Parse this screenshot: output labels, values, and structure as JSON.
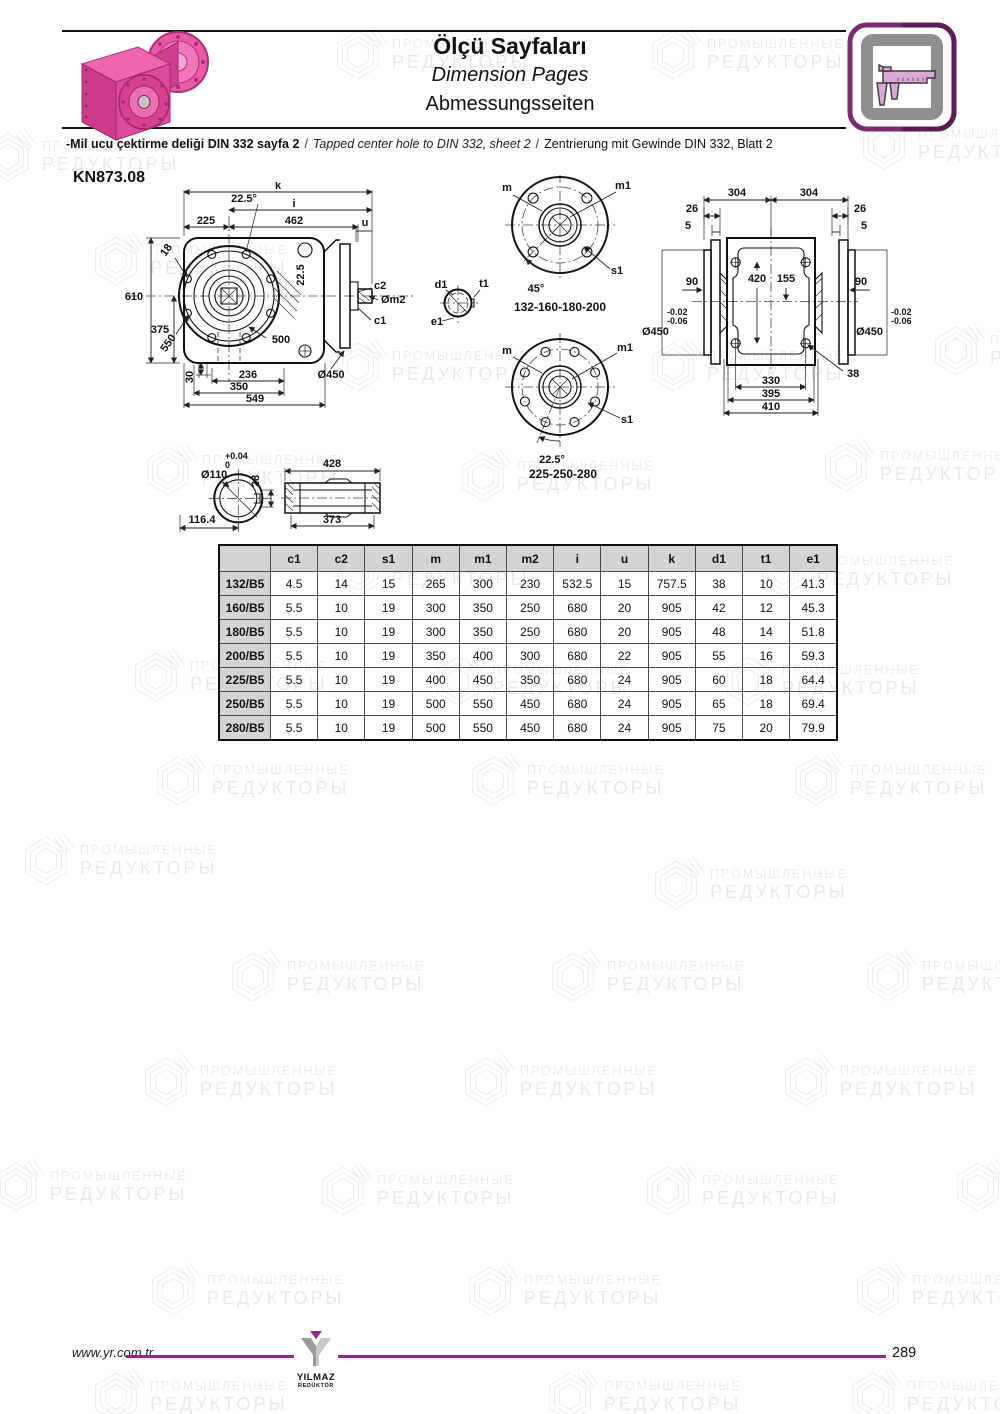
{
  "header": {
    "title_tr": "Ölçü Sayfaları",
    "title_en": "Dimension Pages",
    "title_de": "Abmessungsseiten",
    "note_tr": "-Mil ucu çektirme deliği DIN 332 sayfa 2",
    "note_en": "Tapped center hole to DIN 332, sheet 2",
    "note_de": "Zentrierung mit Gewinde DIN 332, Blatt 2",
    "note_separator": "/"
  },
  "model": "KN873.08",
  "drawings": {
    "front_view": {
      "k": "k",
      "angle_top": "22.5°",
      "i": "i",
      "d225": "225",
      "d462": "462",
      "u": "u",
      "d18": "18",
      "d610": "610",
      "d375": "375",
      "d550": "550",
      "d500": "500",
      "d22_5": "22.5",
      "c2": "c2",
      "m2": "Øm2",
      "c1": "c1",
      "d450": "Ø450",
      "d236": "236",
      "d350": "350",
      "d549": "549",
      "d30": "30"
    },
    "flange_4bolt": {
      "m": "m",
      "m1": "m1",
      "s1": "s1",
      "angle": "45°",
      "caption": "132-160-180-200"
    },
    "shaft_end": {
      "d1": "d1",
      "t1": "t1",
      "e1": "e1"
    },
    "flange_8bolt": {
      "m": "m",
      "m1": "m1",
      "s1": "s1",
      "angle": "22.5°",
      "caption": "225-250-280"
    },
    "top_view": {
      "d304": "304",
      "d26": "26",
      "d5": "5",
      "d90": "90",
      "d420": "420",
      "d155": "155",
      "tol_upper": "-0.02",
      "tol_lower": "-0.06",
      "d450": "Ø450",
      "d330": "330",
      "d395": "395",
      "d410": "410",
      "d38": "38"
    },
    "hollow_shaft": {
      "tol_upper": "+0.04",
      "tol_lower": "0",
      "d110": "Ø110",
      "d28": "28",
      "d428": "428",
      "d373": "373",
      "d116": "116.4"
    }
  },
  "table": {
    "columns": [
      "c1",
      "c2",
      "s1",
      "m",
      "m1",
      "m2",
      "i",
      "u",
      "k",
      "d1",
      "t1",
      "e1"
    ],
    "rows": [
      {
        "label": "132/B5",
        "values": [
          "4.5",
          "14",
          "15",
          "265",
          "300",
          "230",
          "532.5",
          "15",
          "757.5",
          "38",
          "10",
          "41.3"
        ]
      },
      {
        "label": "160/B5",
        "values": [
          "5.5",
          "10",
          "19",
          "300",
          "350",
          "250",
          "680",
          "20",
          "905",
          "42",
          "12",
          "45.3"
        ]
      },
      {
        "label": "180/B5",
        "values": [
          "5.5",
          "10",
          "19",
          "300",
          "350",
          "250",
          "680",
          "20",
          "905",
          "48",
          "14",
          "51.8"
        ]
      },
      {
        "label": "200/B5",
        "values": [
          "5.5",
          "10",
          "19",
          "350",
          "400",
          "300",
          "680",
          "22",
          "905",
          "55",
          "16",
          "59.3"
        ]
      },
      {
        "label": "225/B5",
        "values": [
          "5.5",
          "10",
          "19",
          "400",
          "450",
          "350",
          "680",
          "24",
          "905",
          "60",
          "18",
          "64.4"
        ]
      },
      {
        "label": "250/B5",
        "values": [
          "5.5",
          "10",
          "19",
          "500",
          "550",
          "450",
          "680",
          "24",
          "905",
          "65",
          "18",
          "69.4"
        ]
      },
      {
        "label": "280/B5",
        "values": [
          "5.5",
          "10",
          "19",
          "500",
          "550",
          "450",
          "680",
          "24",
          "905",
          "75",
          "20",
          "79.9"
        ]
      }
    ]
  },
  "footer": {
    "website": "www.yr.com.tr",
    "logo_name": "YILMAZ",
    "logo_subtitle": "REDÜKTÖR",
    "page_number": "289"
  },
  "watermark": {
    "line1": "ПРОМЫШЛЕННЫЕ",
    "line2": "РЕДУКТОРЫ"
  },
  "colors": {
    "accent_purple": "#93278f",
    "gearbox_pink": "#e0459b",
    "table_header_bg": "#d4d4d4"
  }
}
